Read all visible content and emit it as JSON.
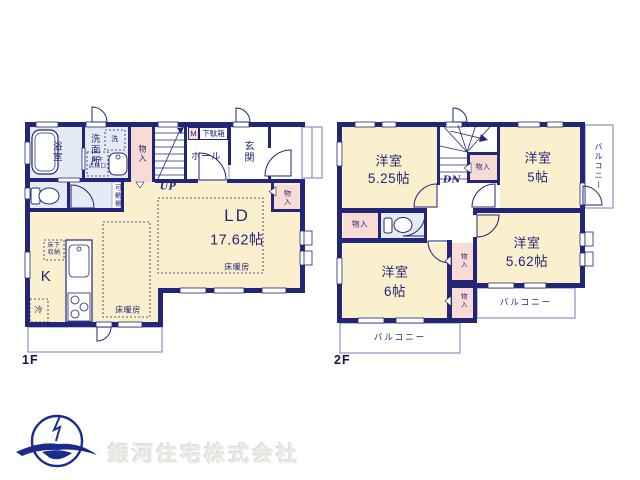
{
  "colors": {
    "wall": "#232677",
    "room": "#FAF0CE",
    "closet": "#F9DBD5",
    "wet": "#E4EBF5",
    "outline": "#8A93C4",
    "logo": "#1A2B8C",
    "label": "#232677",
    "company_text": "#E8E8E4"
  },
  "company": {
    "name": "銀河住宅株式会社"
  },
  "floor1": {
    "label": "1F",
    "ld_name": "LD",
    "ld_size": "17.62帖",
    "ld_heating": "床暖房",
    "kitchen": "K",
    "kitchen_heating": "床暖房",
    "fridge": "冷",
    "underfloor_storage": "床下\n収納",
    "bath": "浴室",
    "washroom": "洗面所",
    "washer": "洗",
    "inspection": "床下\n点検口",
    "hall": "ホール",
    "entrance": "玄関",
    "meter": "M",
    "shoebox": "下駄箱",
    "closet_upper": "物入",
    "closet_ld": "物入",
    "shelf": "可動棚",
    "up": "UP"
  },
  "floor2": {
    "label": "2F",
    "room_nw_name": "洋室",
    "room_nw_size": "5.25帖",
    "room_ne_name": "洋室",
    "room_ne_size": "5帖",
    "room_se_name": "洋室",
    "room_se_size": "5.62帖",
    "room_sw_name": "洋室",
    "room_sw_size": "6帖",
    "dn": "DN",
    "closet_hall": "物入",
    "closet_left": "物入",
    "closet_mid": "物入",
    "closet_low": "物入",
    "balcony_right": "バルコニー",
    "balcony_se": "バルコニー",
    "balcony_sw": "バルコニー"
  }
}
